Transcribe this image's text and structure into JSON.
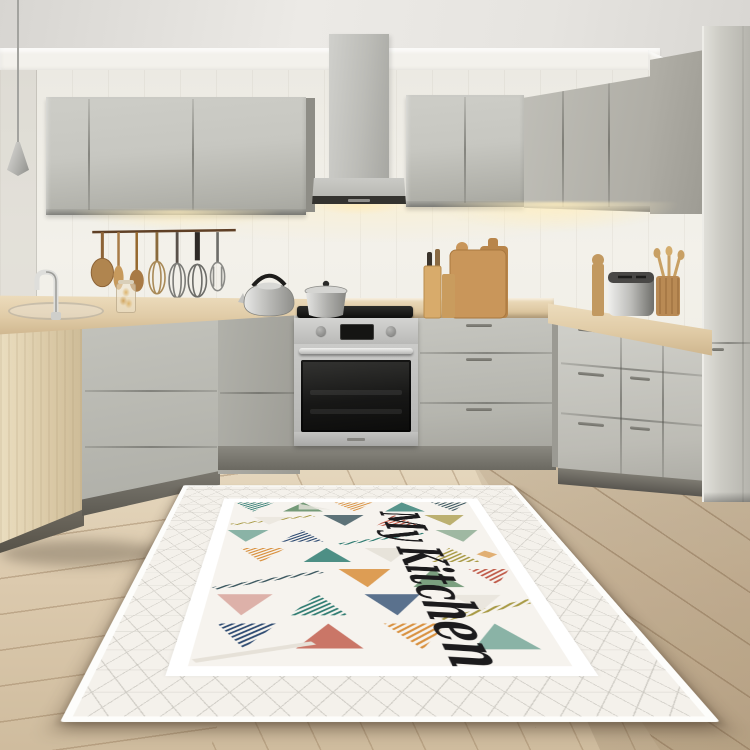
{
  "rug": {
    "text": "My Kitchen",
    "field": "#f6f3ee",
    "band": "#ffffff",
    "lattice_line": "#c0bdb5",
    "ink": "#1c1b1d",
    "palette": [
      "#2f7c72",
      "#6fa294",
      "#5d8a63",
      "#3a565e",
      "#d9913f",
      "#c05a49",
      "#2e4b72",
      "#a89a45",
      "#d8a59c",
      "#8aa98f"
    ]
  },
  "colors": {
    "ceiling": "#e9e7e3",
    "molding": "#f3f1ec",
    "wall": "#f1efe8",
    "cabinet": "#c7c7c1",
    "cabinetdark": "#a09f97",
    "hood": "#c3c3bf",
    "counter": "#e6d3b0",
    "wood": "#c8955a",
    "steel": "#d6d6d4",
    "appliance_black": "#1a1a1a",
    "floor": "#ddcdb2",
    "floordark": "#c6b295",
    "plank": "#a08a69",
    "glow": "#ffe9b8",
    "toekick": "#76746c",
    "rugfield": "#f6f3ee"
  }
}
